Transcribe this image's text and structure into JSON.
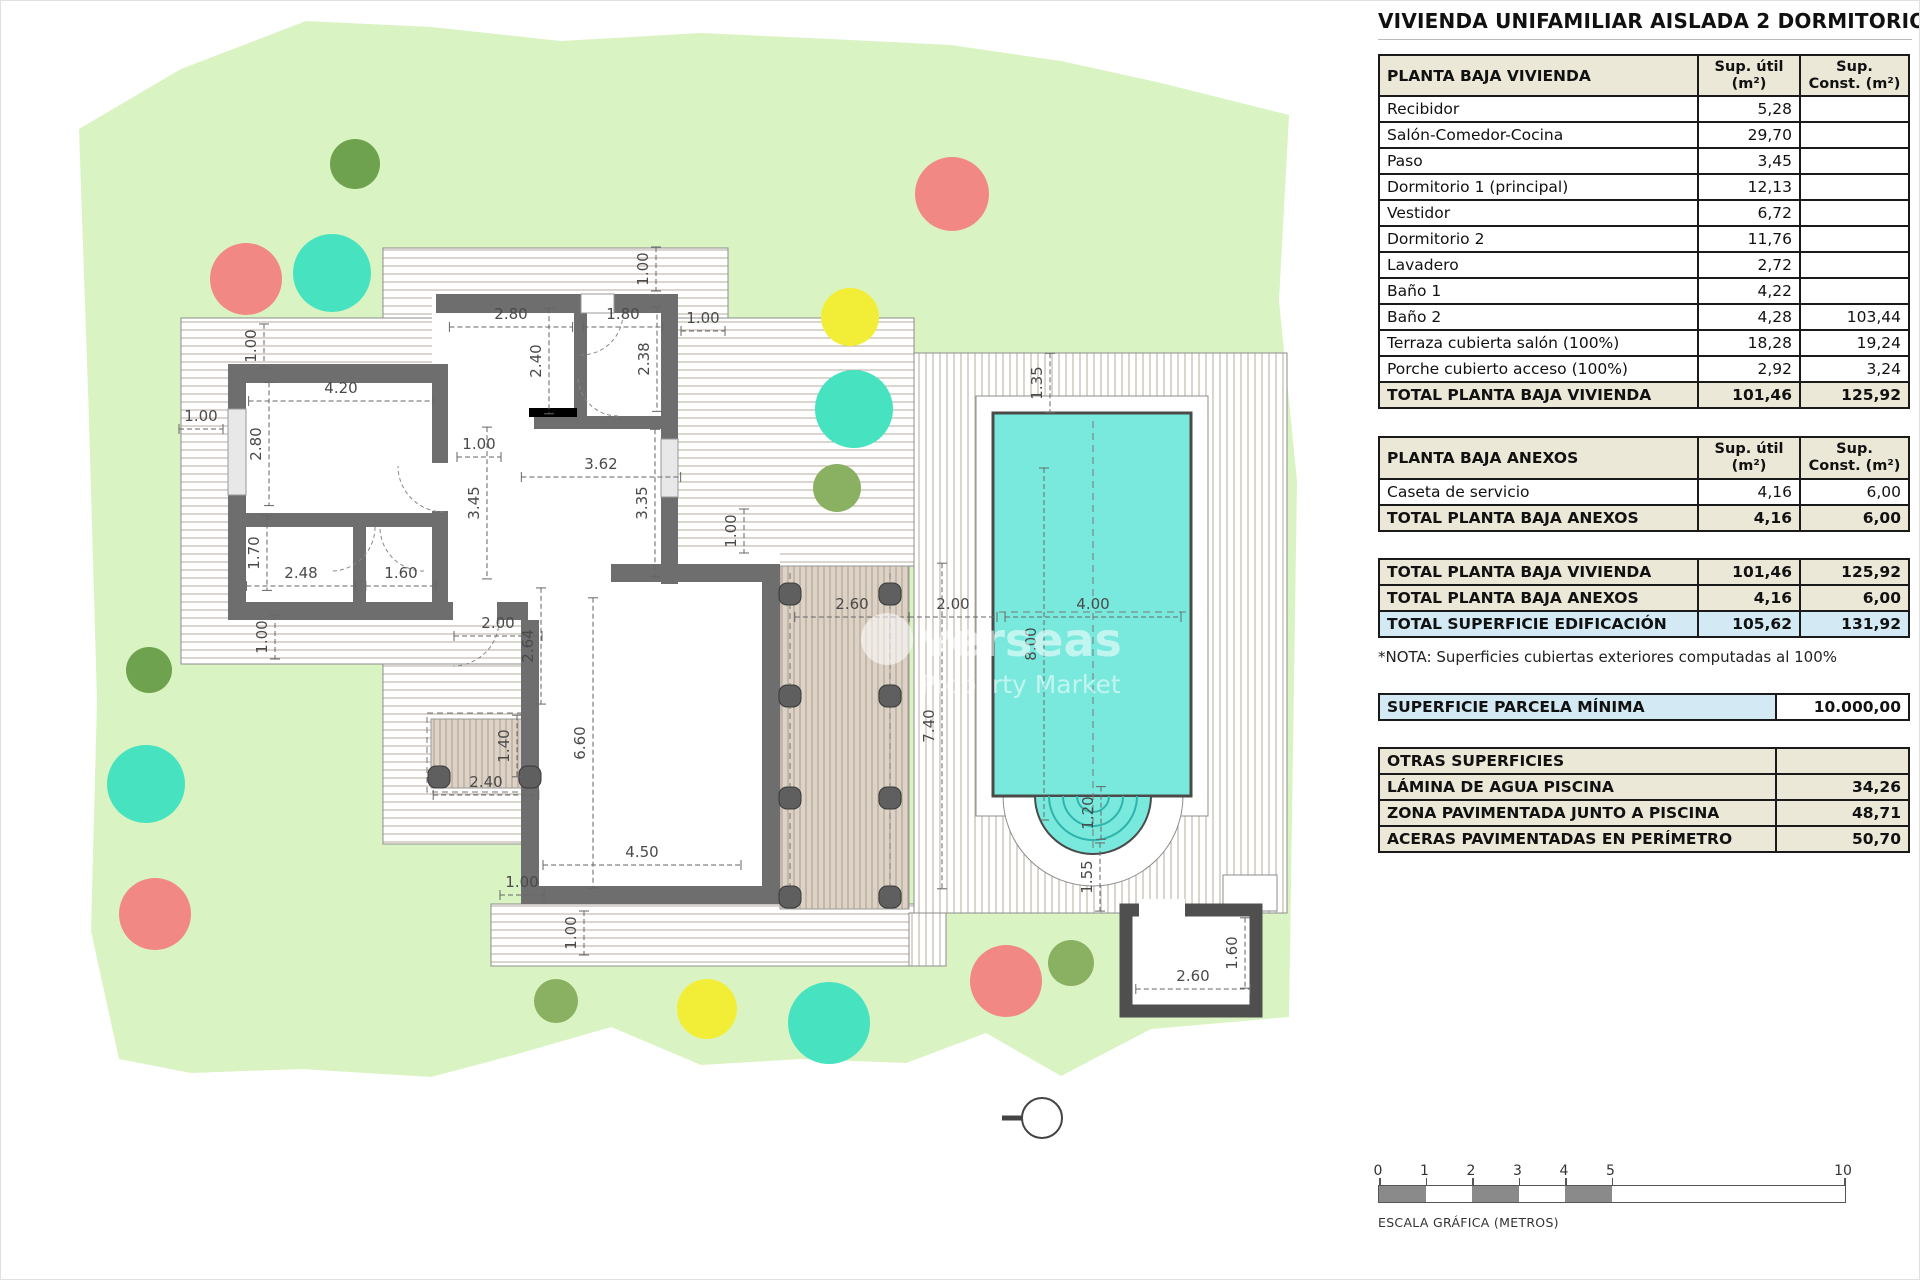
{
  "title": "VIVIENDA UNIFAMILIAR AISLADA 2 DORMITORIOS",
  "colors": {
    "parcel_green": "#daf3c2",
    "pool_water": "#79e9de",
    "wall_gray": "#6e6e6e",
    "header_beige": "#ebe8d8",
    "highlight_blue": "#d3e9f4",
    "tree_red": "#f28884",
    "tree_teal": "#47e3c0",
    "tree_yellow": "#f2ee38",
    "tree_darkgreen": "#6fa24e",
    "tree_green": "#8ab061"
  },
  "tables": {
    "vivienda": {
      "header": "PLANTA BAJA VIVIENDA",
      "col_util": "Sup. útil (m²)",
      "col_const": "Sup. Const. (m²)",
      "rows": [
        {
          "label": "Recibidor",
          "util": "5,28",
          "cons": ""
        },
        {
          "label": "Salón-Comedor-Cocina",
          "util": "29,70",
          "cons": ""
        },
        {
          "label": "Paso",
          "util": "3,45",
          "cons": ""
        },
        {
          "label": "Dormitorio 1 (principal)",
          "util": "12,13",
          "cons": ""
        },
        {
          "label": "Vestidor",
          "util": "6,72",
          "cons": ""
        },
        {
          "label": "Dormitorio 2",
          "util": "11,76",
          "cons": ""
        },
        {
          "label": "Lavadero",
          "util": "2,72",
          "cons": ""
        },
        {
          "label": "Baño 1",
          "util": "4,22",
          "cons": ""
        },
        {
          "label": "Baño 2",
          "util": "4,28",
          "cons": "103,44"
        },
        {
          "label": "Terraza cubierta salón (100%)",
          "util": "18,28",
          "cons": "19,24"
        },
        {
          "label": "Porche cubierto acceso (100%)",
          "util": "2,92",
          "cons": "3,24"
        }
      ],
      "total": {
        "label": "TOTAL PLANTA BAJA VIVIENDA",
        "util": "101,46",
        "cons": "125,92"
      }
    },
    "anexos": {
      "header": "PLANTA BAJA ANEXOS",
      "col_util": "Sup. útil (m²)",
      "col_const": "Sup. Const. (m²)",
      "rows": [
        {
          "label": "Caseta de servicio",
          "util": "4,16",
          "cons": "6,00"
        }
      ],
      "total": {
        "label": "TOTAL PLANTA BAJA ANEXOS",
        "util": "4,16",
        "cons": "6,00"
      }
    },
    "totales": {
      "rows": [
        {
          "label": "TOTAL PLANTA BAJA VIVIENDA",
          "util": "101,46",
          "cons": "125,92",
          "style": "beige"
        },
        {
          "label": "TOTAL PLANTA BAJA ANEXOS",
          "util": "4,16",
          "cons": "6,00",
          "style": "beige"
        },
        {
          "label": "TOTAL SUPERFICIE EDIFICACIÓN",
          "util": "105,62",
          "cons": "131,92",
          "style": "blue"
        }
      ]
    },
    "nota": "*NOTA: Superficies cubiertas exteriores computadas al 100%",
    "parcela": {
      "label": "SUPERFICIE PARCELA MÍNIMA",
      "value": "10.000,00"
    },
    "otras": {
      "header": "OTRAS SUPERFICIES",
      "rows": [
        {
          "label": "LÁMINA DE AGUA PISCINA",
          "value": "34,26"
        },
        {
          "label": "ZONA PAVIMENTADA JUNTO A PISCINA",
          "value": "48,71"
        },
        {
          "label": "ACERAS PAVIMENTADAS EN PERÍMETRO",
          "value": "50,70"
        }
      ]
    }
  },
  "scalebar": {
    "ticks": [
      0,
      1,
      2,
      3,
      4,
      5,
      10
    ],
    "filled": [
      [
        0,
        1
      ],
      [
        2,
        3
      ],
      [
        4,
        5
      ]
    ],
    "caption": "ESCALA GRÁFICA (METROS)"
  },
  "watermark": {
    "line1": "verseas",
    "line2": "Property Market"
  },
  "plan": {
    "dims": [
      {
        "t": "2.80",
        "x": 510,
        "y": 318,
        "o": "h"
      },
      {
        "t": "1.80",
        "x": 622,
        "y": 318,
        "o": "h"
      },
      {
        "t": "1.00",
        "x": 702,
        "y": 322,
        "o": "h"
      },
      {
        "t": "4.20",
        "x": 340,
        "y": 392,
        "o": "h"
      },
      {
        "t": "1.00",
        "x": 200,
        "y": 420,
        "o": "h"
      },
      {
        "t": "1.00",
        "x": 478,
        "y": 448,
        "o": "h"
      },
      {
        "t": "3.62",
        "x": 600,
        "y": 468,
        "o": "h"
      },
      {
        "t": "2.48",
        "x": 300,
        "y": 577,
        "o": "h"
      },
      {
        "t": "1.60",
        "x": 400,
        "y": 577,
        "o": "h"
      },
      {
        "t": "2.00",
        "x": 497,
        "y": 627,
        "o": "h"
      },
      {
        "t": "2.40",
        "x": 485,
        "y": 786,
        "o": "h"
      },
      {
        "t": "2.60",
        "x": 851,
        "y": 608,
        "o": "h"
      },
      {
        "t": "2.00",
        "x": 952,
        "y": 608,
        "o": "h"
      },
      {
        "t": "4.00",
        "x": 1092,
        "y": 608,
        "o": "h"
      },
      {
        "t": "4.50",
        "x": 641,
        "y": 856,
        "o": "h"
      },
      {
        "t": "1.00",
        "x": 521,
        "y": 886,
        "o": "h"
      },
      {
        "t": "2.60",
        "x": 1192,
        "y": 980,
        "o": "h"
      },
      {
        "t": "1.00",
        "x": 647,
        "y": 268,
        "o": "v"
      },
      {
        "t": "1.00",
        "x": 255,
        "y": 345,
        "o": "v"
      },
      {
        "t": "2.40",
        "x": 540,
        "y": 360,
        "o": "v"
      },
      {
        "t": "2.38",
        "x": 648,
        "y": 358,
        "o": "v"
      },
      {
        "t": "2.80",
        "x": 260,
        "y": 443,
        "o": "v"
      },
      {
        "t": "3.45",
        "x": 478,
        "y": 502,
        "o": "v"
      },
      {
        "t": "3.35",
        "x": 646,
        "y": 502,
        "o": "v"
      },
      {
        "t": "1.70",
        "x": 258,
        "y": 552,
        "o": "v"
      },
      {
        "t": "1.00",
        "x": 266,
        "y": 636,
        "o": "v"
      },
      {
        "t": "2.64",
        "x": 532,
        "y": 645,
        "o": "v"
      },
      {
        "t": "1.40",
        "x": 508,
        "y": 745,
        "o": "v"
      },
      {
        "t": "6.60",
        "x": 584,
        "y": 742,
        "o": "v"
      },
      {
        "t": "1.00",
        "x": 575,
        "y": 932,
        "o": "v"
      },
      {
        "t": "1.35",
        "x": 1041,
        "y": 382,
        "o": "v"
      },
      {
        "t": "8.00",
        "x": 1035,
        "y": 643,
        "o": "v"
      },
      {
        "t": "7.40",
        "x": 933,
        "y": 725,
        "o": "v"
      },
      {
        "t": "1.20",
        "x": 1092,
        "y": 812,
        "o": "v"
      },
      {
        "t": "1.55",
        "x": 1091,
        "y": 876,
        "o": "v"
      },
      {
        "t": "1.00",
        "x": 735,
        "y": 530,
        "o": "v"
      },
      {
        "t": "1.60",
        "x": 1236,
        "y": 952,
        "o": "v"
      }
    ],
    "trees": [
      {
        "x": 354,
        "y": 163,
        "r": 25,
        "c": "#6fa24e"
      },
      {
        "x": 951,
        "y": 193,
        "r": 37,
        "c": "#f28884"
      },
      {
        "x": 245,
        "y": 278,
        "r": 36,
        "c": "#f28884"
      },
      {
        "x": 331,
        "y": 272,
        "r": 39,
        "c": "#47e3c0"
      },
      {
        "x": 849,
        "y": 316,
        "r": 29,
        "c": "#f2ee38"
      },
      {
        "x": 853,
        "y": 408,
        "r": 39,
        "c": "#47e3c0"
      },
      {
        "x": 836,
        "y": 487,
        "r": 24,
        "c": "#8ab061"
      },
      {
        "x": 148,
        "y": 669,
        "r": 23,
        "c": "#6fa24e"
      },
      {
        "x": 145,
        "y": 783,
        "r": 39,
        "c": "#47e3c0"
      },
      {
        "x": 154,
        "y": 913,
        "r": 36,
        "c": "#f28884"
      },
      {
        "x": 555,
        "y": 1000,
        "r": 22,
        "c": "#8ab061"
      },
      {
        "x": 706,
        "y": 1008,
        "r": 30,
        "c": "#f2ee38"
      },
      {
        "x": 828,
        "y": 1022,
        "r": 41,
        "c": "#47e3c0"
      },
      {
        "x": 1005,
        "y": 980,
        "r": 36,
        "c": "#f28884"
      },
      {
        "x": 1070,
        "y": 962,
        "r": 23,
        "c": "#8ab061"
      }
    ],
    "columns": [
      [
        789,
        593
      ],
      [
        889,
        593
      ],
      [
        789,
        695
      ],
      [
        889,
        695
      ],
      [
        789,
        797
      ],
      [
        889,
        797
      ],
      [
        789,
        896
      ],
      [
        889,
        896
      ],
      [
        438,
        776
      ],
      [
        529,
        776
      ]
    ],
    "arcs": [
      [
        580,
        312,
        42,
        0,
        90
      ],
      [
        443,
        465,
        46,
        90,
        180
      ],
      [
        330,
        526,
        44,
        0,
        90
      ],
      [
        423,
        526,
        44,
        90,
        180
      ],
      [
        617,
        375,
        40,
        90,
        180
      ],
      [
        452,
        619,
        46,
        0,
        90
      ],
      [
        1182,
        916,
        42,
        90,
        180
      ]
    ]
  }
}
